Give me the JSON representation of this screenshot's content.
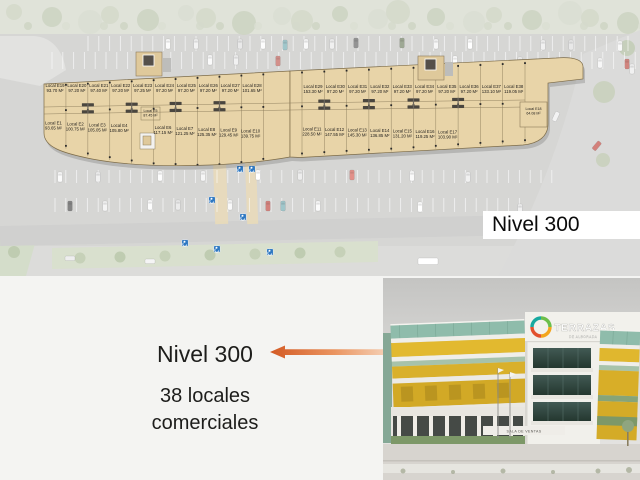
{
  "slide": {
    "background": "#f4f4f2"
  },
  "site_plan": {
    "nivel_badge": "Nivel 300",
    "plan_fill": "#e8d4a8",
    "plan_stroke": "#7d6c49",
    "asphalt": "#c8c8c6",
    "locals": [
      {
        "id": "Local E1",
        "area": "93.65 M²",
        "row": "left_bottom",
        "slot": 0
      },
      {
        "id": "Local E2",
        "area": "100.75 M²",
        "row": "left_bottom",
        "slot": 1
      },
      {
        "id": "Local E3",
        "area": "105.05 M²",
        "row": "left_bottom",
        "slot": 2
      },
      {
        "id": "Local E4",
        "area": "105.80 M²",
        "row": "left_bottom",
        "slot": 3
      },
      {
        "id": "Local E5",
        "area": "87.45 M²",
        "row": "small",
        "slot": 0
      },
      {
        "id": "Local E6",
        "area": "117.15 M²",
        "row": "left_bottom",
        "slot": 5
      },
      {
        "id": "Local E7",
        "area": "121.25 M²",
        "row": "left_bottom",
        "slot": 6
      },
      {
        "id": "Local E8",
        "area": "125.35 M²",
        "row": "left_bottom",
        "slot": 7
      },
      {
        "id": "Local E9",
        "area": "129.45 M²",
        "row": "left_bottom",
        "slot": 8
      },
      {
        "id": "Local E10",
        "area": "139.75 M²",
        "row": "left_bottom",
        "slot": 9
      },
      {
        "id": "Local E11",
        "area": "228.50 M²",
        "row": "right_bottom",
        "slot": 0
      },
      {
        "id": "Local E12",
        "area": "147.55 M²",
        "row": "right_bottom",
        "slot": 1
      },
      {
        "id": "Local E13",
        "area": "145.30 M²",
        "row": "right_bottom",
        "slot": 2
      },
      {
        "id": "Local E14",
        "area": "136.85 M²",
        "row": "right_bottom",
        "slot": 3
      },
      {
        "id": "Local E15",
        "area": "131.20 M²",
        "row": "right_bottom",
        "slot": 4
      },
      {
        "id": "Local E16",
        "area": "119.25 M²",
        "row": "right_bottom",
        "slot": 5
      },
      {
        "id": "Local E17",
        "area": "103.90 M²",
        "row": "right_bottom",
        "slot": 6
      },
      {
        "id": "Local E18",
        "area": "64.08 M²",
        "row": "small",
        "slot": 1
      },
      {
        "id": "Local E19",
        "area": "93.70 M²",
        "row": "left_top",
        "slot": 0
      },
      {
        "id": "Local E20",
        "area": "97.20 M²",
        "row": "left_top",
        "slot": 1
      },
      {
        "id": "Local E21",
        "area": "97.40 M²",
        "row": "left_top",
        "slot": 2
      },
      {
        "id": "Local E22",
        "area": "97.20 M²",
        "row": "left_top",
        "slot": 3
      },
      {
        "id": "Local E23",
        "area": "97.25 M²",
        "row": "left_top",
        "slot": 4
      },
      {
        "id": "Local E24",
        "area": "97.20 M²",
        "row": "left_top",
        "slot": 5
      },
      {
        "id": "Local E25",
        "area": "97.20 M²",
        "row": "left_top",
        "slot": 6
      },
      {
        "id": "Local E26",
        "area": "97.20 M²",
        "row": "left_top",
        "slot": 7
      },
      {
        "id": "Local E27",
        "area": "97.20 M²",
        "row": "left_top",
        "slot": 8
      },
      {
        "id": "Local E28",
        "area": "101.65 M²",
        "row": "left_top",
        "slot": 9
      },
      {
        "id": "Local E29",
        "area": "153.30 M²",
        "row": "right_top",
        "slot": 0
      },
      {
        "id": "Local E30",
        "area": "97.20 M²",
        "row": "right_top",
        "slot": 1
      },
      {
        "id": "Local E31",
        "area": "97.20 M²",
        "row": "right_top",
        "slot": 2
      },
      {
        "id": "Local E32",
        "area": "97.20 M²",
        "row": "right_top",
        "slot": 3
      },
      {
        "id": "Local E33",
        "area": "97.20 M²",
        "row": "right_top",
        "slot": 4
      },
      {
        "id": "Local E34",
        "area": "97.20 M²",
        "row": "right_top",
        "slot": 5
      },
      {
        "id": "Local E35",
        "area": "97.20 M²",
        "row": "right_top",
        "slot": 6
      },
      {
        "id": "Local E36",
        "area": "97.20 M²",
        "row": "right_top",
        "slot": 7
      },
      {
        "id": "Local E37",
        "area": "133.10 M²",
        "row": "right_top",
        "slot": 8
      },
      {
        "id": "Local E38",
        "area": "119.05 M²",
        "row": "right_top",
        "slot": 9
      }
    ],
    "handicap_color": "#2e78c2",
    "handicap_spots": [
      [
        240,
        169
      ],
      [
        252,
        169
      ],
      [
        212,
        200
      ],
      [
        243,
        217
      ],
      [
        185,
        243
      ],
      [
        217,
        249
      ],
      [
        270,
        252
      ]
    ],
    "cars": [
      [
        168,
        39,
        "#fbfbfb",
        "v"
      ],
      [
        196,
        39,
        "#efefef",
        "v"
      ],
      [
        240,
        39,
        "#e2e2e2",
        "v"
      ],
      [
        263,
        39,
        "#fdfdfd",
        "v"
      ],
      [
        285,
        40,
        "#7fb2b8",
        "v"
      ],
      [
        306,
        39,
        "#f7f7f7",
        "v"
      ],
      [
        332,
        39,
        "#ebebeb",
        "v"
      ],
      [
        356,
        38,
        "#6e6e6e",
        "v"
      ],
      [
        402,
        38,
        "#7d8a6f",
        "v"
      ],
      [
        436,
        39,
        "#f4f4f4",
        "v"
      ],
      [
        470,
        39,
        "#ffffff",
        "v"
      ],
      [
        543,
        40,
        "#ededed",
        "v"
      ],
      [
        571,
        40,
        "#e1e1e1",
        "v"
      ],
      [
        620,
        41,
        "#f6f6f6",
        "v"
      ],
      [
        210,
        55,
        "#fafafa",
        "v"
      ],
      [
        236,
        55,
        "#ececec",
        "v"
      ],
      [
        278,
        56,
        "#c46a62",
        "v"
      ],
      [
        420,
        56,
        "#f0f0f0",
        "v"
      ],
      [
        455,
        56,
        "#fefefe",
        "v"
      ],
      [
        520,
        57,
        "#ebebeb",
        "v"
      ],
      [
        600,
        58,
        "#f5f5f5",
        "v"
      ],
      [
        627,
        59,
        "#c05a52",
        "v"
      ],
      [
        60,
        172,
        "#fafafa",
        "v"
      ],
      [
        98,
        172,
        "#ececec",
        "v"
      ],
      [
        160,
        171,
        "#fcfcfc",
        "v"
      ],
      [
        203,
        171,
        "#f3f3f3",
        "v"
      ],
      [
        258,
        170,
        "#ffffff",
        "v"
      ],
      [
        300,
        170,
        "#e7e7e7",
        "v"
      ],
      [
        352,
        170,
        "#d86a60",
        "v"
      ],
      [
        412,
        171,
        "#f9f9f9",
        "v"
      ],
      [
        468,
        172,
        "#ededed",
        "v"
      ],
      [
        70,
        201,
        "#585858",
        "v"
      ],
      [
        105,
        201,
        "#f1f1f1",
        "v"
      ],
      [
        150,
        200,
        "#fbfbfb",
        "v"
      ],
      [
        178,
        200,
        "#e5e5e5",
        "v"
      ],
      [
        230,
        200,
        "#f7f7f7",
        "v"
      ],
      [
        268,
        201,
        "#c4554e",
        "v"
      ],
      [
        283,
        201,
        "#7fb2b8",
        "v"
      ],
      [
        318,
        201,
        "#fafafa",
        "v"
      ],
      [
        420,
        202,
        "#ffffff",
        "v"
      ],
      [
        520,
        204,
        "#ececec",
        "v"
      ],
      [
        428,
        258,
        "#ffffff",
        "b"
      ],
      [
        70,
        256,
        "#e8e8e8",
        "h"
      ],
      [
        150,
        259,
        "#f2f2f2",
        "h"
      ],
      [
        600,
        142,
        "#c4554e",
        "r40"
      ],
      [
        558,
        112,
        "#efefef",
        "r25"
      ],
      [
        632,
        64,
        "#ededed",
        "v"
      ]
    ]
  },
  "callout": {
    "heading": "Nivel 300",
    "line1": "38 locales",
    "line2": "comerciales",
    "arrow_dark": "#d35a24",
    "arrow_mid": "#ea9460",
    "arrow_light": "#f7ddc8"
  },
  "photo": {
    "logo_text": "TERRAZAS",
    "logo_subtext": "DE ALBORADA",
    "sign_text": "SALA DE VENTAS",
    "ring_colors": [
      "#17a9a0",
      "#6cbf4a",
      "#f3a51d",
      "#e2512e"
    ]
  }
}
